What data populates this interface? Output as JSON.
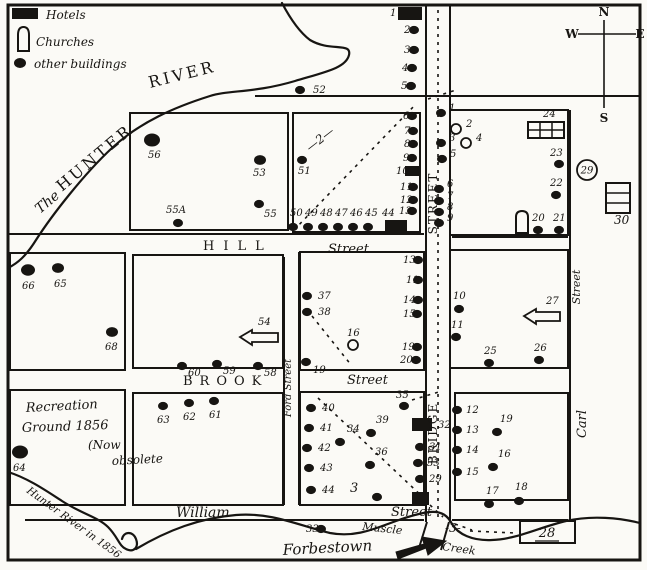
{
  "legend": {
    "hotels": "Hotels",
    "churches": "Churches",
    "other": "other buildings"
  },
  "compass": {
    "n": "N",
    "e": "E",
    "s": "S",
    "w": "W"
  },
  "map": {
    "ink": "#171512",
    "paper": "#fbfaf6",
    "border": [
      8,
      5,
      632,
      555
    ],
    "blocks": [
      [
        130,
        113,
        158,
        117
      ],
      [
        293,
        113,
        127,
        119
      ],
      [
        450,
        110,
        118,
        125
      ],
      [
        10,
        253,
        115,
        117
      ],
      [
        133,
        255,
        150,
        113
      ],
      [
        300,
        252,
        124,
        118
      ],
      [
        450,
        250,
        118,
        118
      ],
      [
        10,
        390,
        115,
        115
      ],
      [
        133,
        393,
        150,
        112
      ],
      [
        300,
        392,
        124,
        113
      ],
      [
        455,
        393,
        113,
        107
      ]
    ],
    "street_lines": [
      [
        8,
        234,
        424,
        234
      ],
      [
        452,
        237,
        568,
        237
      ],
      [
        255,
        96,
        640,
        96
      ],
      [
        25,
        520,
        424,
        520
      ],
      [
        452,
        520,
        568,
        520
      ],
      [
        426,
        5,
        426,
        522
      ],
      [
        450,
        5,
        450,
        522
      ],
      [
        427,
        522,
        419,
        548
      ],
      [
        449,
        522,
        441,
        550
      ],
      [
        284,
        257,
        284,
        505
      ],
      [
        299,
        252,
        299,
        505
      ],
      [
        570,
        110,
        570,
        520
      ]
    ],
    "rivers": [
      {
        "name": "hunter-river-upper",
        "d": "M282,3 C292,22 302,34 310,40 C330,52 352,42 349,55 C346,68 325,72 295,81 C255,93 228,90 210,96 C175,107 140,122 112,148 C84,174 52,215 36,240 C26,256 18,263 8,268"
      },
      {
        "name": "hunter-river-1856",
        "d": "M8,472 C28,478 48,492 62,501 C82,514 98,517 108,527 C118,537 119,546 126,549 C134,553 139,547 136,539 C133,531 124,531 122,539"
      },
      {
        "name": "muscle-creek",
        "d": "M136,549 C168,530 200,518 236,515 C272,512 300,526 330,533 C356,538 376,528 396,521 C410,516 420,513 430,512 C442,511 448,516 452,524 C458,534 472,541 492,540 C518,539 540,527 566,521 C592,515 620,518 640,523"
      }
    ],
    "routes": [
      {
        "name": "route-2-dashed",
        "d": "M294,230 L416,104"
      },
      {
        "name": "route-2-dashed-ext",
        "d": "M428,99 L456,90"
      },
      {
        "name": "route-2-block-diagonal",
        "d": "M312,316 L352,366"
      },
      {
        "name": "route-3-dashed",
        "d": "M318,398 L428,502"
      },
      {
        "name": "route-3-dashed-b",
        "d": "M430,505 L443,517"
      },
      {
        "name": "route-3-dashed-c",
        "d": "M455,524 L472,530"
      },
      {
        "name": "route-3-dashed-east",
        "d": "M470,531 L516,533"
      },
      {
        "name": "route-35-dash",
        "d": "M412,400 L442,391"
      },
      {
        "name": "bridge-street-centerline",
        "d": "M438,10 L438,518"
      }
    ],
    "dots": [
      {
        "n": "2",
        "x": 414,
        "y": 30,
        "lx": 404,
        "ly": 33
      },
      {
        "n": "3",
        "x": 414,
        "y": 50,
        "lx": 404,
        "ly": 53
      },
      {
        "n": "4",
        "x": 412,
        "y": 68,
        "lx": 402,
        "ly": 71
      },
      {
        "n": "5",
        "x": 411,
        "y": 86,
        "lx": 401,
        "ly": 89
      },
      {
        "n": "6",
        "x": 412,
        "y": 116,
        "lx": 403,
        "ly": 119
      },
      {
        "n": "7",
        "x": 413,
        "y": 131,
        "lx": 404,
        "ly": 134
      },
      {
        "n": "8",
        "x": 413,
        "y": 144,
        "lx": 404,
        "ly": 147
      },
      {
        "n": "9",
        "x": 412,
        "y": 158,
        "lx": 403,
        "ly": 161
      },
      {
        "n": "11",
        "x": 413,
        "y": 187,
        "lx": 400,
        "ly": 190
      },
      {
        "n": "12",
        "x": 413,
        "y": 200,
        "lx": 400,
        "ly": 203
      },
      {
        "n": "13",
        "x": 412,
        "y": 211,
        "lx": 399,
        "ly": 214
      },
      {
        "n": "13",
        "x": 418,
        "y": 260,
        "lx": 403,
        "ly": 263
      },
      {
        "n": "11",
        "x": 418,
        "y": 280,
        "lx": 406,
        "ly": 283
      },
      {
        "n": "14",
        "x": 418,
        "y": 300,
        "lx": 403,
        "ly": 303
      },
      {
        "n": "15",
        "x": 417,
        "y": 314,
        "lx": 403,
        "ly": 317
      },
      {
        "n": "19",
        "x": 417,
        "y": 347,
        "lx": 402,
        "ly": 350
      },
      {
        "n": "20",
        "x": 416,
        "y": 360,
        "lx": 400,
        "ly": 363
      },
      {
        "n": "37",
        "x": 307,
        "y": 296,
        "lx": 318,
        "ly": 299
      },
      {
        "n": "38",
        "x": 307,
        "y": 312,
        "lx": 318,
        "ly": 315
      },
      {
        "n": "19",
        "x": 306,
        "y": 362,
        "lx": 313,
        "ly": 373
      },
      {
        "n": "51",
        "x": 302,
        "y": 160,
        "lx": 298,
        "ly": 174
      },
      {
        "n": "52",
        "x": 300,
        "y": 90,
        "lx": 313,
        "ly": 93
      },
      {
        "n": "50",
        "x": 293,
        "y": 227,
        "lx": 290,
        "ly": 216
      },
      {
        "n": "49",
        "x": 308,
        "y": 227,
        "lx": 305,
        "ly": 216
      },
      {
        "n": "48",
        "x": 323,
        "y": 227,
        "lx": 320,
        "ly": 216
      },
      {
        "n": "47",
        "x": 338,
        "y": 227,
        "lx": 335,
        "ly": 216
      },
      {
        "n": "46",
        "x": 353,
        "y": 227,
        "lx": 350,
        "ly": 216
      },
      {
        "n": "45",
        "x": 368,
        "y": 227,
        "lx": 365,
        "ly": 216
      },
      {
        "n": "56",
        "x": 152,
        "y": 140,
        "lx": 148,
        "ly": 158,
        "r": 8
      },
      {
        "n": "53",
        "x": 260,
        "y": 160,
        "lx": 253,
        "ly": 176,
        "r": 6
      },
      {
        "n": "55",
        "x": 259,
        "y": 204,
        "lx": 264,
        "ly": 217
      },
      {
        "n": "55A",
        "x": 178,
        "y": 223,
        "lx": 166,
        "ly": 213
      },
      {
        "n": "66",
        "x": 28,
        "y": 270,
        "lx": 22,
        "ly": 289,
        "r": 7
      },
      {
        "n": "65",
        "x": 58,
        "y": 268,
        "lx": 54,
        "ly": 287,
        "r": 6
      },
      {
        "n": "68",
        "x": 112,
        "y": 332,
        "lx": 105,
        "ly": 350,
        "r": 6
      },
      {
        "n": "60",
        "x": 182,
        "y": 366,
        "lx": 188,
        "ly": 376
      },
      {
        "n": "59",
        "x": 217,
        "y": 364,
        "lx": 223,
        "ly": 374
      },
      {
        "n": "58",
        "x": 258,
        "y": 366,
        "lx": 264,
        "ly": 376
      },
      {
        "n": "63",
        "x": 163,
        "y": 406,
        "lx": 157,
        "ly": 423
      },
      {
        "n": "62",
        "x": 189,
        "y": 403,
        "lx": 183,
        "ly": 420
      },
      {
        "n": "61",
        "x": 214,
        "y": 401,
        "lx": 209,
        "ly": 418
      },
      {
        "n": "64",
        "x": 20,
        "y": 452,
        "lx": 13,
        "ly": 471,
        "r": 8
      },
      {
        "n": "40",
        "x": 311,
        "y": 408,
        "lx": 322,
        "ly": 411
      },
      {
        "n": "41",
        "x": 309,
        "y": 428,
        "lx": 320,
        "ly": 431
      },
      {
        "n": "42",
        "x": 307,
        "y": 448,
        "lx": 318,
        "ly": 451
      },
      {
        "n": "43",
        "x": 309,
        "y": 468,
        "lx": 320,
        "ly": 471
      },
      {
        "n": "44",
        "x": 311,
        "y": 490,
        "lx": 322,
        "ly": 493
      },
      {
        "n": "34",
        "x": 340,
        "y": 442,
        "lx": 347,
        "ly": 432
      },
      {
        "n": "39",
        "x": 371,
        "y": 433,
        "lx": 376,
        "ly": 423
      },
      {
        "n": "36",
        "x": 370,
        "y": 465,
        "lx": 375,
        "ly": 455
      },
      {
        "n": "",
        "x": 377,
        "y": 497,
        "lx": 0,
        "ly": 0
      },
      {
        "n": "35",
        "x": 404,
        "y": 406,
        "lx": 396,
        "ly": 398
      },
      {
        "n": "31",
        "x": 420,
        "y": 447,
        "lx": 429,
        "ly": 450
      },
      {
        "n": "33",
        "x": 418,
        "y": 463,
        "lx": 427,
        "ly": 466
      },
      {
        "n": "29",
        "x": 420,
        "y": 479,
        "lx": 429,
        "ly": 482
      },
      {
        "n": "10",
        "x": 459,
        "y": 309,
        "lx": 453,
        "ly": 299
      },
      {
        "n": "11",
        "x": 456,
        "y": 337,
        "lx": 451,
        "ly": 328
      },
      {
        "n": "25",
        "x": 489,
        "y": 363,
        "lx": 484,
        "ly": 354
      },
      {
        "n": "26",
        "x": 539,
        "y": 360,
        "lx": 534,
        "ly": 351
      },
      {
        "n": "1",
        "x": 441,
        "y": 113,
        "lx": 449,
        "ly": 111
      },
      {
        "n": "3",
        "x": 441,
        "y": 143,
        "lx": 449,
        "ly": 141
      },
      {
        "n": "5",
        "x": 442,
        "y": 159,
        "lx": 450,
        "ly": 157
      },
      {
        "n": "6",
        "x": 439,
        "y": 189,
        "lx": 447,
        "ly": 187
      },
      {
        "n": "7",
        "x": 439,
        "y": 201,
        "lx": 447,
        "ly": 199
      },
      {
        "n": "8",
        "x": 439,
        "y": 212,
        "lx": 447,
        "ly": 210
      },
      {
        "n": "9",
        "x": 439,
        "y": 223,
        "lx": 447,
        "ly": 221
      },
      {
        "n": "23",
        "x": 559,
        "y": 164,
        "lx": 550,
        "ly": 156
      },
      {
        "n": "22",
        "x": 556,
        "y": 195,
        "lx": 550,
        "ly": 186
      },
      {
        "n": "20",
        "x": 538,
        "y": 230,
        "lx": 532,
        "ly": 221
      },
      {
        "n": "21",
        "x": 559,
        "y": 230,
        "lx": 553,
        "ly": 221
      },
      {
        "n": "12",
        "x": 457,
        "y": 410,
        "lx": 466,
        "ly": 413
      },
      {
        "n": "13",
        "x": 457,
        "y": 430,
        "lx": 466,
        "ly": 433
      },
      {
        "n": "14",
        "x": 457,
        "y": 450,
        "lx": 466,
        "ly": 453
      },
      {
        "n": "15",
        "x": 457,
        "y": 472,
        "lx": 466,
        "ly": 475
      },
      {
        "n": "19",
        "x": 497,
        "y": 432,
        "lx": 500,
        "ly": 422
      },
      {
        "n": "16",
        "x": 493,
        "y": 467,
        "lx": 498,
        "ly": 457
      },
      {
        "n": "17",
        "x": 489,
        "y": 504,
        "lx": 486,
        "ly": 494
      },
      {
        "n": "18",
        "x": 519,
        "y": 501,
        "lx": 515,
        "ly": 490
      },
      {
        "n": "33",
        "x": 321,
        "y": 529,
        "lx": 306,
        "ly": 532
      }
    ],
    "open_circles": [
      {
        "n": "2",
        "x": 456,
        "y": 129,
        "lx": 466,
        "ly": 127
      },
      {
        "n": "4",
        "x": 466,
        "y": 143,
        "lx": 476,
        "ly": 141
      },
      {
        "n": "16",
        "x": 353,
        "y": 345,
        "lx": 347,
        "ly": 336
      }
    ],
    "circled_numbers": [
      {
        "n": "29",
        "x": 587,
        "y": 170,
        "r": 10
      }
    ],
    "hotels": [
      {
        "n": "1",
        "x": 398,
        "y": 7,
        "w": 24,
        "h": 13,
        "lx": 390,
        "ly": 16
      },
      {
        "n": "10",
        "x": 405,
        "y": 166,
        "w": 14,
        "h": 10,
        "lx": 396,
        "ly": 174
      },
      {
        "n": "44",
        "x": 385,
        "y": 220,
        "w": 22,
        "h": 12,
        "lx": 382,
        "ly": 216
      },
      {
        "n": "32",
        "x": 412,
        "y": 418,
        "w": 20,
        "h": 13,
        "lx": 438,
        "ly": 428
      },
      {
        "n": "",
        "x": 412,
        "y": 492,
        "w": 17,
        "h": 13,
        "lx": 0,
        "ly": 0
      }
    ],
    "churches": [
      {
        "x": 516,
        "y": 211,
        "w": 12,
        "h": 22
      }
    ],
    "legend_church": {
      "x": 17,
      "y": 27,
      "w": 13,
      "h": 24
    },
    "grid_building": {
      "n": "24",
      "x": 528,
      "y": 122,
      "w": 36,
      "h": 16,
      "lx": 543,
      "ly": 117
    },
    "row_building": {
      "n": "30",
      "x": 606,
      "y": 183,
      "w": 24,
      "h": 30,
      "lx": 614,
      "ly": 224
    },
    "box_building": {
      "n": "28",
      "x": 520,
      "y": 521,
      "w": 55,
      "h": 22,
      "lx": 547,
      "ly": 537
    },
    "arrow_buildings": [
      {
        "n": "54",
        "pts": "240,337 252,330 252,333 278,333 278,342 252,342 252,345",
        "lx": 258,
        "ly": 325
      },
      {
        "n": "27",
        "pts": "524,316 536,309 536,312 560,312 560,321 536,321 536,324",
        "lx": 546,
        "ly": 304
      }
    ],
    "bridge_marker": {
      "pts": "396,552 424,544 422,537 446,541 428,555 426,548 398,559"
    },
    "texts": [
      {
        "t": "The",
        "x": 40,
        "y": 214,
        "rot": -40,
        "size": 14,
        "it": 1
      },
      {
        "t": "HUNTER",
        "x": 62,
        "y": 192,
        "rot": -40,
        "size": 16,
        "sp": 3
      },
      {
        "t": "RIVER",
        "x": 150,
        "y": 88,
        "rot": -14,
        "size": 16,
        "sp": 3
      },
      {
        "t": "HILL",
        "x": 203,
        "y": 250,
        "rot": 0,
        "size": 13,
        "sp": 9
      },
      {
        "t": "Street",
        "x": 328,
        "y": 253,
        "rot": 0,
        "size": 13,
        "it": 1
      },
      {
        "t": "BROOK",
        "x": 183,
        "y": 385,
        "rot": 0,
        "size": 13,
        "sp": 7
      },
      {
        "t": "Street",
        "x": 347,
        "y": 384,
        "rot": 0,
        "size": 13,
        "it": 1
      },
      {
        "t": "William",
        "x": 176,
        "y": 517,
        "rot": 0,
        "size": 14,
        "it": 1
      },
      {
        "t": "Street",
        "x": 391,
        "y": 516,
        "rot": 0,
        "size": 13,
        "it": 1
      },
      {
        "t": "STREET",
        "x": 437,
        "y": 203,
        "rot": -90,
        "size": 12,
        "sp": 2,
        "mid": 1
      },
      {
        "t": "BRIDGE",
        "x": 437,
        "y": 433,
        "rot": -90,
        "size": 12,
        "sp": 2,
        "mid": 1
      },
      {
        "t": "Ford Street",
        "x": 291,
        "y": 388,
        "rot": -90,
        "size": 10,
        "it": 1,
        "mid": 1
      },
      {
        "t": "Street",
        "x": 580,
        "y": 287,
        "rot": -90,
        "size": 11,
        "it": 1,
        "mid": 1
      },
      {
        "t": "Carl",
        "x": 586,
        "y": 424,
        "rot": -90,
        "size": 13,
        "it": 1,
        "mid": 1
      },
      {
        "t": "Hunter River in 1856",
        "x": 26,
        "y": 492,
        "rot": 36,
        "size": 10.5,
        "it": 1
      },
      {
        "t": "Muscle",
        "x": 362,
        "y": 530,
        "rot": 6,
        "size": 11,
        "it": 1
      },
      {
        "t": "Creek",
        "x": 442,
        "y": 550,
        "rot": 8,
        "size": 11,
        "it": 1
      },
      {
        "t": "Forbestown",
        "x": 283,
        "y": 555,
        "rot": -3,
        "size": 15,
        "it": 1
      },
      {
        "t": "Recreation",
        "x": 26,
        "y": 412,
        "rot": -3,
        "size": 13,
        "it": 1
      },
      {
        "t": "Ground 1856",
        "x": 22,
        "y": 432,
        "rot": -2,
        "size": 13,
        "it": 1
      },
      {
        "t": "(Now",
        "x": 88,
        "y": 449,
        "rot": 0,
        "size": 12,
        "it": 1
      },
      {
        "t": "obsolete",
        "x": 112,
        "y": 465,
        "rot": -3,
        "size": 12,
        "it": 1
      },
      {
        "t": "—2—",
        "x": 310,
        "y": 152,
        "rot": -38,
        "size": 12,
        "it": 1
      },
      {
        "t": "3",
        "x": 350,
        "y": 492,
        "rot": 0,
        "size": 13,
        "it": 1
      },
      {
        "t": "-3-",
        "x": 445,
        "y": 532,
        "rot": 0,
        "size": 12,
        "it": 1
      }
    ]
  }
}
